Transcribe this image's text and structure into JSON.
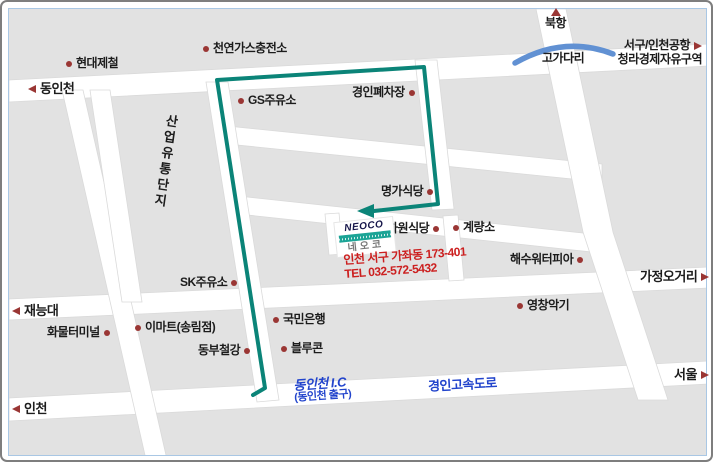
{
  "labels": {
    "dongincheon": "동인천",
    "hyundai_steel": "현대제철",
    "cng_station": "천연가스충전소",
    "bukhang": "북항",
    "gogadari": "고가다리",
    "seogu_airport": "서구/인천공항",
    "cheongna": "청라경제자유구역",
    "gs_station": "GS주유소",
    "junkyard": "경인폐차장",
    "industrial_complex": "산업유통단지",
    "myeongga": "명가식당",
    "hawon": "하원식당",
    "gyeryangso": "계량소",
    "waterpia": "해수워터피아",
    "gajeong_crossing": "가정오거리",
    "yeongchang": "영창악기",
    "sk_station": "SK주유소",
    "jaeneung": "재능대",
    "cargo_terminal": "화물터미널",
    "emart": "이마트(송림점)",
    "dongbu_steel": "동부철강",
    "kb_bank": "국민은행",
    "bluecon": "블루콘",
    "seoul": "서울",
    "incheon": "인천",
    "ic": "동인천 I.C",
    "ic_sub": "(동인천 출구)",
    "highway": "경인고속도로"
  },
  "neoco": {
    "logo_en": "NEOCO",
    "logo_ko": "네오코",
    "address": "인천 서구 가좌동 173-401",
    "tel": "TEL 032-572-5432"
  },
  "colors": {
    "map_background": "#e2e2e2",
    "road": "#ffffff",
    "route": "#0b8478",
    "marker": "#9a3634",
    "blue_text": "#2244cc",
    "address_text": "#cc2020",
    "overpass": "#6191d3",
    "inner_border": "#a9c7e4"
  }
}
